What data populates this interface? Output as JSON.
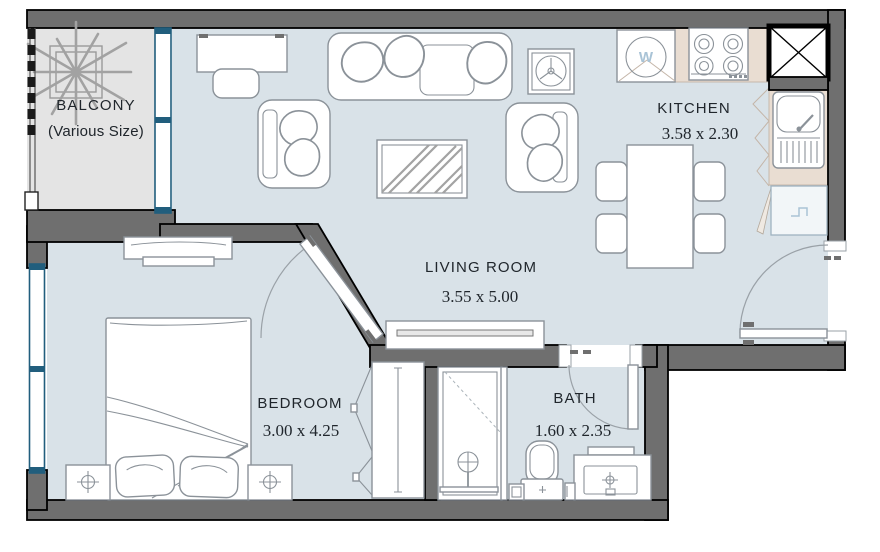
{
  "plan": {
    "rooms": {
      "balcony": {
        "label": "BALCONY",
        "sublabel": "(Various Size)"
      },
      "living_room": {
        "label": "LIVING ROOM",
        "dimensions": "3.55 x 5.00"
      },
      "kitchen": {
        "label": "KITCHEN",
        "dimensions": "3.58 x 2.30",
        "washer_glyph": "W"
      },
      "bedroom": {
        "label": "BEDROOM",
        "dimensions": "3.00 x 4.25"
      },
      "bath": {
        "label": "BATH",
        "dimensions": "1.60 x 2.35"
      }
    },
    "colors": {
      "wall": "#6f6f6f",
      "floor": "#d9e2e8",
      "balcony_floor": "#e4e4e4",
      "counter": "#e9ddd2",
      "window": "#215e7d",
      "furniture": "#8b9299",
      "appliance_blue": "#a9c3d6",
      "text": "#20262c"
    }
  }
}
